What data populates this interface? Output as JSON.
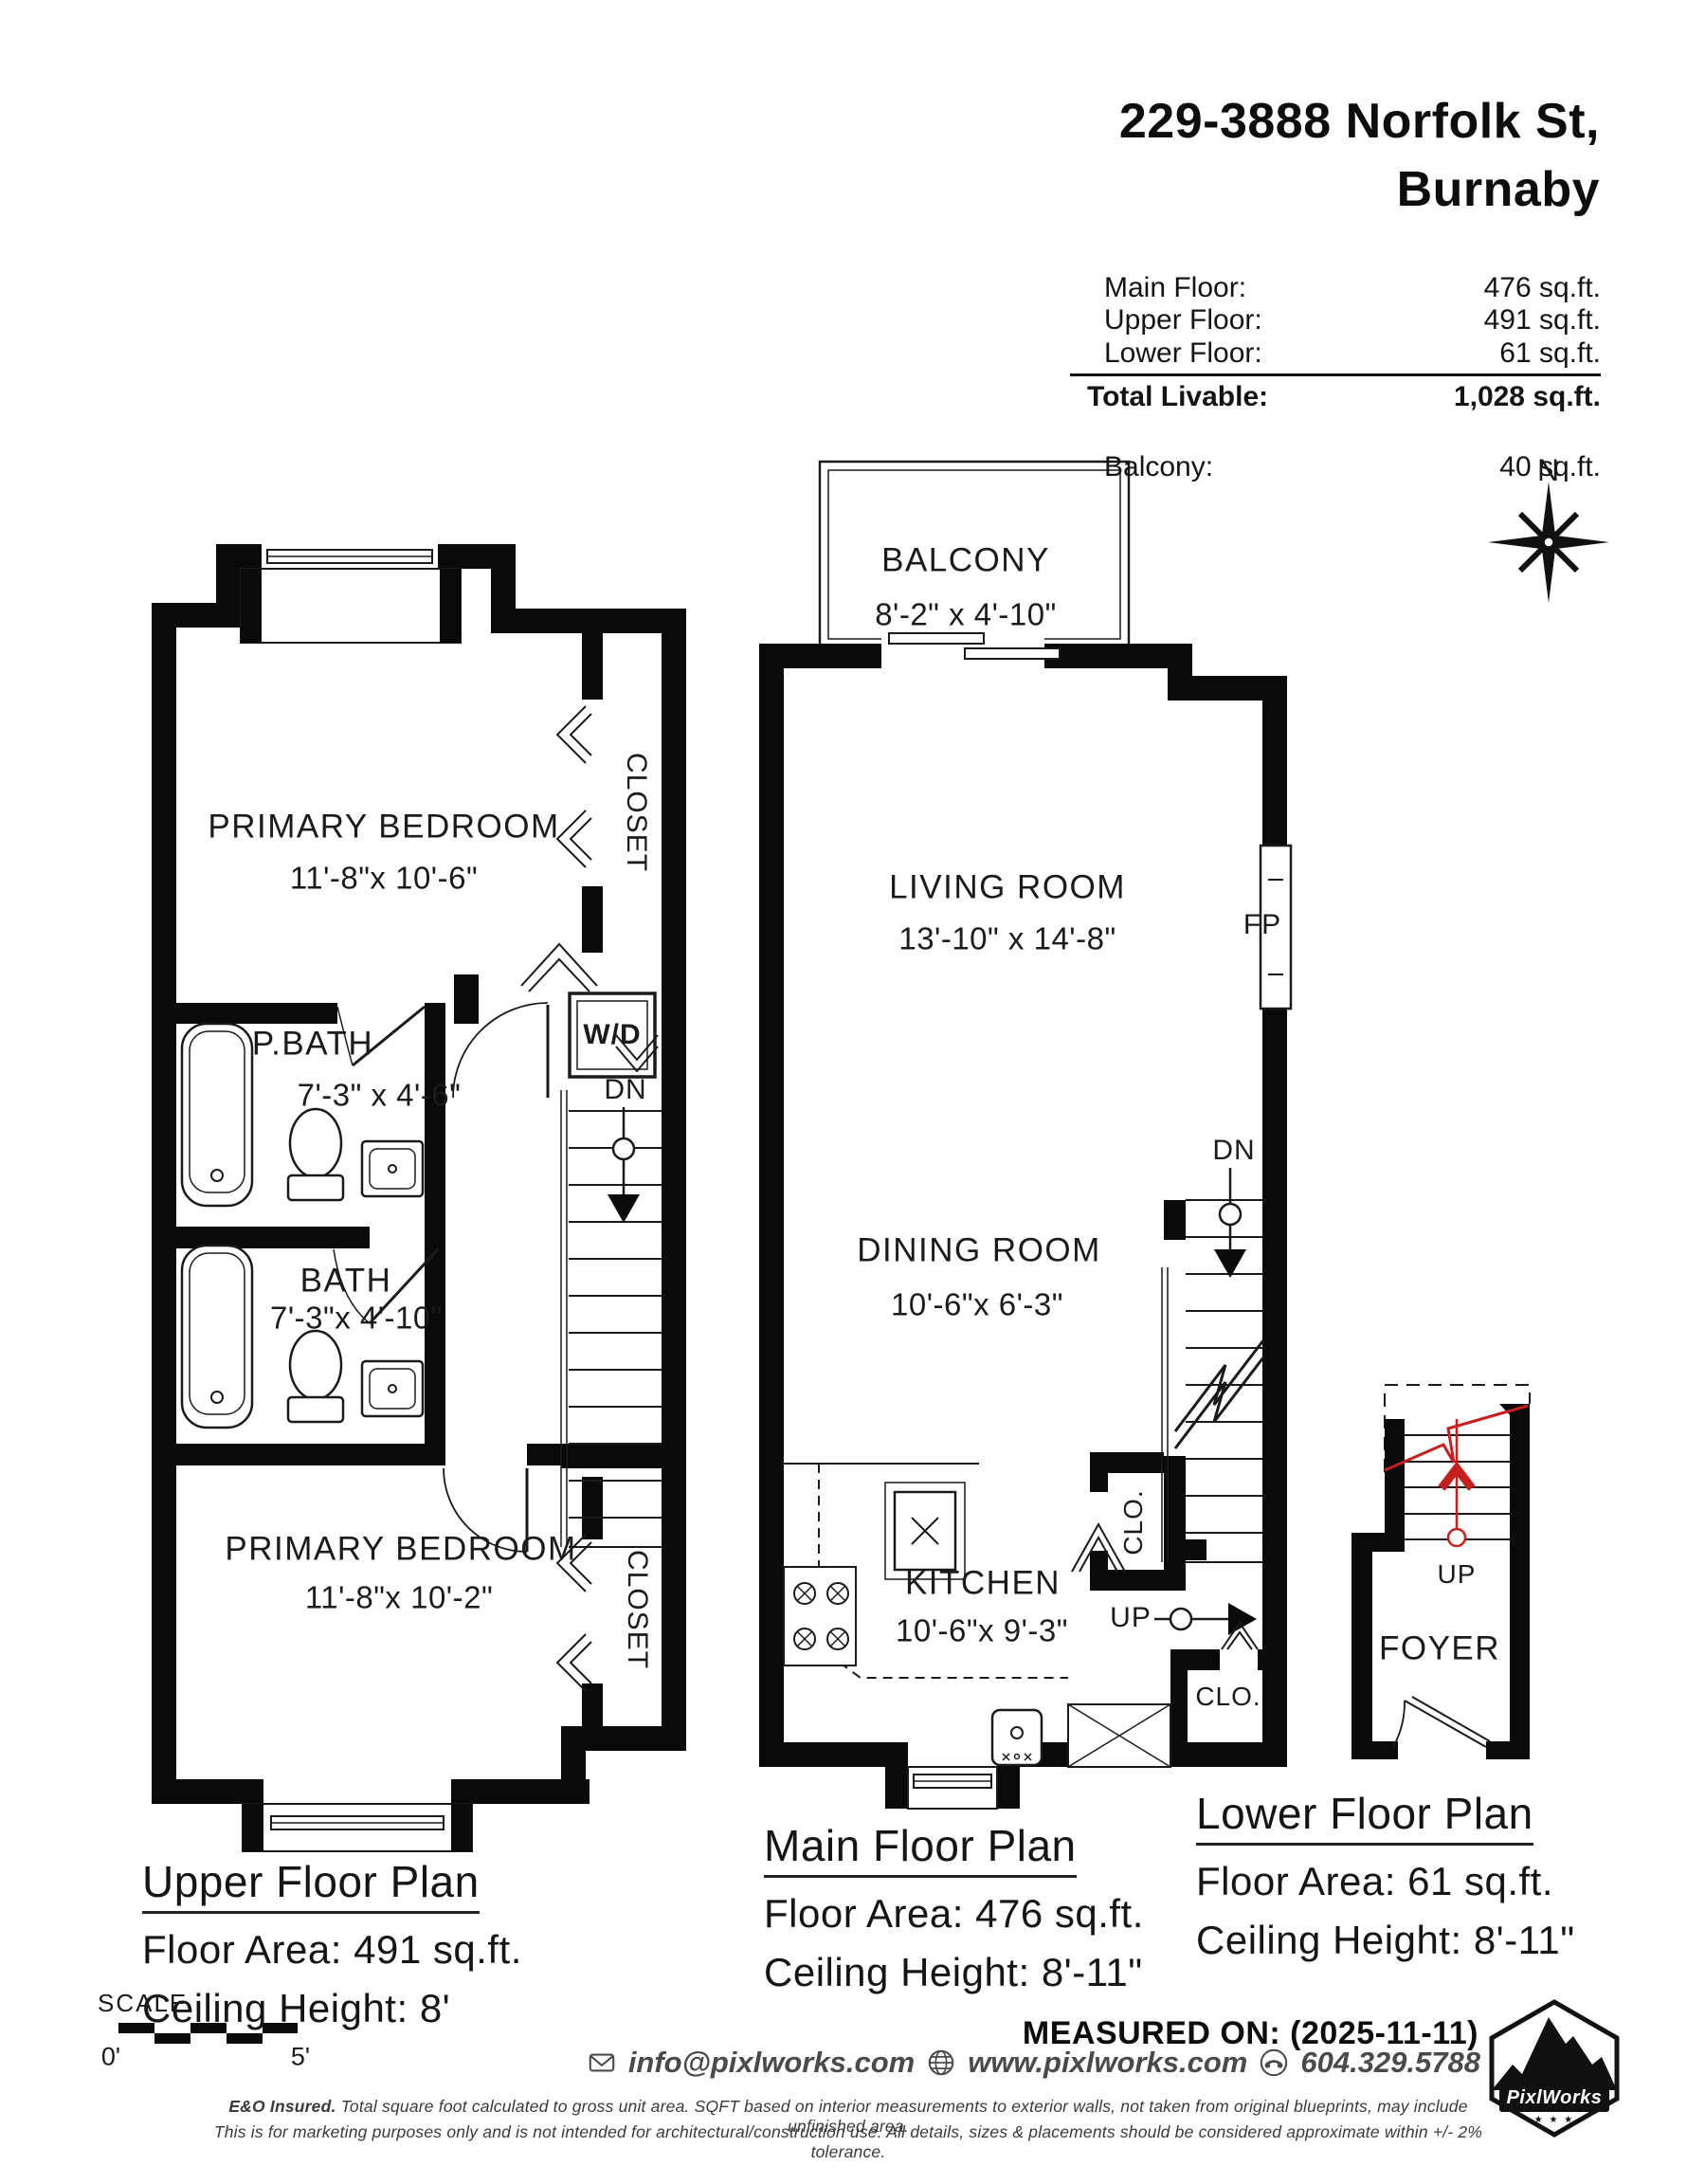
{
  "header": {
    "address_line1": "229-3888 Norfolk St,",
    "address_line2": "Burnaby",
    "area_rows": [
      {
        "label": "Main Floor:",
        "value": "476 sq.ft."
      },
      {
        "label": "Upper Floor:",
        "value": "491 sq.ft."
      },
      {
        "label": "Lower Floor:",
        "value": "61 sq.ft."
      }
    ],
    "total_row": {
      "label": "Total Livable:",
      "value": "1,028 sq.ft."
    },
    "balcony_row": {
      "label": "Balcony:",
      "value": "40 sq.ft."
    }
  },
  "compass": {
    "north": "N"
  },
  "upper_plan": {
    "bedroom_top": {
      "name": "PRIMARY BEDROOM",
      "dims": "11'-8\"x 10'-6\""
    },
    "closet_top": "CLOSET",
    "wd": "W/D",
    "pbath": {
      "name": "P.BATH",
      "dims": "7'-3\" x  4'-6\""
    },
    "dn": "DN",
    "bath": {
      "name": "BATH",
      "dims": "7'-3\"x 4'-10\""
    },
    "bedroom_bottom": {
      "name": "PRIMARY BEDROOM",
      "dims": "11'-8\"x 10'-2\""
    },
    "closet_bottom": "CLOSET",
    "title": "Upper Floor Plan",
    "floor_area": "Floor Area: 491 sq.ft.",
    "ceiling": "Ceiling Height: 8'"
  },
  "main_plan": {
    "balcony": {
      "name": "BALCONY",
      "dims": "8'-2\" x 4'-10\""
    },
    "living": {
      "name": "LIVING ROOM",
      "dims": "13'-10\" x 14'-8\""
    },
    "fp": "FP",
    "dn": "DN",
    "dining": {
      "name": "DINING ROOM",
      "dims": "10'-6\"x  6'-3\""
    },
    "kitchen": {
      "name": "KITCHEN",
      "dims": "10'-6\"x  9'-3\""
    },
    "clo_upper": "CLO.",
    "up": "UP",
    "clo_lower": "CLO.",
    "title": "Main Floor Plan",
    "floor_area": "Floor Area: 476 sq.ft.",
    "ceiling": "Ceiling Height: 8'-11\""
  },
  "lower_plan": {
    "up": "UP",
    "foyer": "FOYER",
    "title": "Lower Floor Plan",
    "floor_area": "Floor Area: 61 sq.ft.",
    "ceiling": "Ceiling Height: 8'-11\""
  },
  "footer": {
    "scale_label": "SCALE",
    "scale_zero": "0'",
    "scale_five": "5'",
    "measured_on": "MEASURED ON: (2025-11-11)",
    "email": "info@pixlworks.com",
    "website": "www.pixlworks.com",
    "phone": "604.329.5788",
    "disclaimer_bold": "E&O Insured.",
    "disclaimer_line1": "Total square foot calculated to gross unit area. SQFT based on interior measurements to exterior walls, not taken from original blueprints, may include unfinished area.",
    "disclaimer_line2": "This is for marketing purposes only and is not intended for architectural/construction use.  All details, sizes & placements should be considered approximate within +/- 2%  tolerance."
  },
  "logo": {
    "name": "PixlWorks",
    "stars": "★ ★ ★"
  },
  "colors": {
    "wall": "#0a0a0a",
    "red_accent": "#c42020",
    "gray_text": "#4a4a4a"
  }
}
